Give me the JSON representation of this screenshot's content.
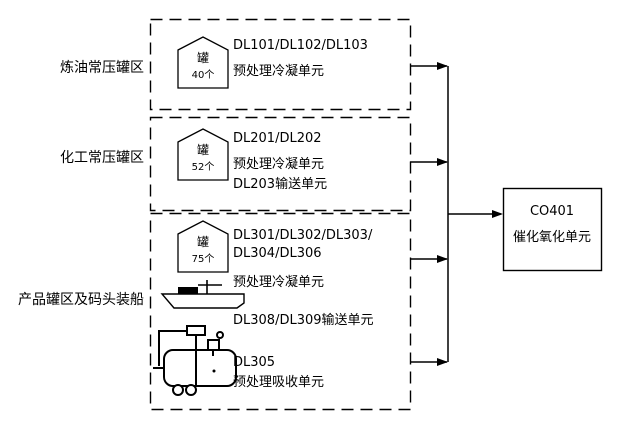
{
  "colors": {
    "line": "#000000",
    "background": "#ffffff"
  },
  "groups": [
    {
      "label": "炼油常压罐区",
      "tank": {
        "glyph": "罐",
        "count": "40个"
      },
      "lines": [
        "DL101/DL102/DL103",
        "预处理冷凝单元"
      ]
    },
    {
      "label": "化工常压罐区",
      "tank": {
        "glyph": "罐",
        "count": "52个"
      },
      "lines": [
        "DL201/DL202",
        "预处理冷凝单元",
        "DL203输送单元"
      ]
    },
    {
      "label": "产品罐区及码头装船",
      "tank": {
        "glyph": "罐",
        "count": "75个"
      },
      "lines": [
        "DL301/DL302/DL303/",
        "DL304/DL306",
        "预处理冷凝单元",
        "DL308/DL309输送单元",
        "DL305",
        "预处理吸收单元"
      ]
    }
  ],
  "destination": {
    "code": "CO401",
    "name": "催化氧化单元"
  }
}
